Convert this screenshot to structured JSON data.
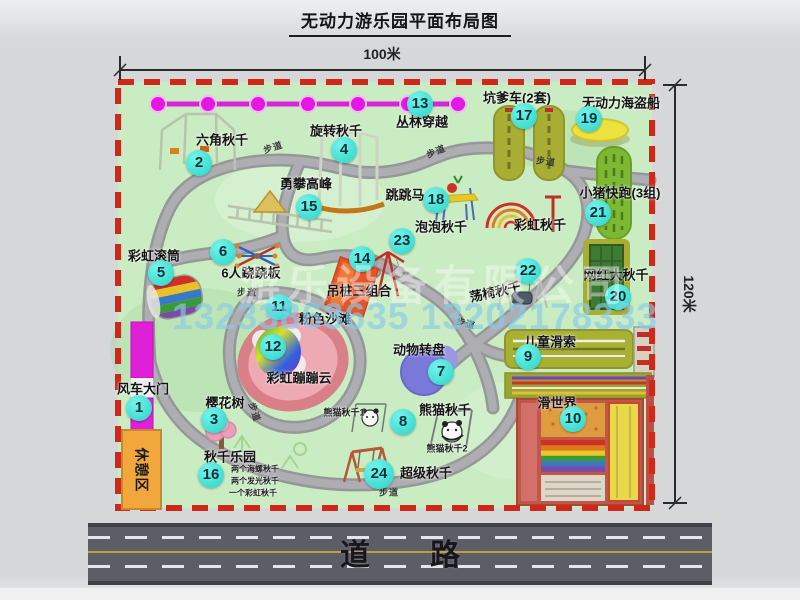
{
  "title": "无动力游乐园平面布局图",
  "dimensions": {
    "top": "100米",
    "right": "120米"
  },
  "road": {
    "label": "道　　路"
  },
  "watermark": {
    "company": "游乐设备有限公司",
    "phone": "13233863635 13202178333"
  },
  "rest_area_label": "休憩区",
  "walkway_text": "步道",
  "colors": {
    "map_green": "#c9ecc2",
    "border_dash": "#d02818",
    "path_gray": "#a6a6aa",
    "badge_cyan": "#2bd3c7",
    "gate_magenta": "#e020d8",
    "zipline_magenta": "#dd22dd",
    "road_gray": "#5d5d66",
    "rest_orange": "#f2a73c",
    "beach_pink": "#d97f88"
  },
  "extra_labels": [
    {
      "text": "彩虹秋千",
      "x": 540,
      "y": 224
    }
  ],
  "walkways": [
    {
      "x": 273,
      "y": 147,
      "rot": -18
    },
    {
      "x": 436,
      "y": 151,
      "rot": -22
    },
    {
      "x": 546,
      "y": 161,
      "rot": 8
    },
    {
      "x": 247,
      "y": 292,
      "rot": 0
    },
    {
      "x": 255,
      "y": 412,
      "rot": 72
    },
    {
      "x": 466,
      "y": 323,
      "rot": 14
    },
    {
      "x": 389,
      "y": 492,
      "rot": 0
    }
  ],
  "attractions": [
    {
      "id": 1,
      "name": "风车大门",
      "badge": {
        "x": 139,
        "y": 408
      },
      "label": {
        "x": 143,
        "y": 388
      }
    },
    {
      "id": 2,
      "name": "六角秋千",
      "badge": {
        "x": 199,
        "y": 163
      },
      "label": {
        "x": 222,
        "y": 139
      }
    },
    {
      "id": 3,
      "name": "樱花树",
      "badge": {
        "x": 214,
        "y": 420
      },
      "label": {
        "x": 225,
        "y": 402
      }
    },
    {
      "id": 4,
      "name": "旋转秋千",
      "badge": {
        "x": 344,
        "y": 150
      },
      "label": {
        "x": 336,
        "y": 130
      }
    },
    {
      "id": 5,
      "name": "彩虹滚筒",
      "badge": {
        "x": 161,
        "y": 273
      },
      "label": {
        "x": 154,
        "y": 255
      }
    },
    {
      "id": 6,
      "name": "6人跷跷板",
      "badge": {
        "x": 223,
        "y": 252
      },
      "label": {
        "x": 251,
        "y": 272
      }
    },
    {
      "id": 7,
      "name": "动物转盘",
      "badge": {
        "x": 441,
        "y": 372
      },
      "label": {
        "x": 419,
        "y": 349
      }
    },
    {
      "id": 8,
      "name": "熊猫秋千",
      "badge": {
        "x": 403,
        "y": 422
      },
      "label": {
        "x": 445,
        "y": 409
      },
      "subs": [
        {
          "text": "熊猫秋千1",
          "x": 344,
          "y": 412,
          "size": 9
        },
        {
          "text": "熊猫秋千2",
          "x": 447,
          "y": 448,
          "size": 9
        }
      ]
    },
    {
      "id": 9,
      "name": "儿童滑索",
      "badge": {
        "x": 528,
        "y": 357
      },
      "label": {
        "x": 550,
        "y": 341
      }
    },
    {
      "id": 10,
      "name": "滑世界",
      "badge": {
        "x": 573,
        "y": 419
      },
      "label": {
        "x": 557,
        "y": 402
      }
    },
    {
      "id": 11,
      "name": "粉色沙滩",
      "badge": {
        "x": 279,
        "y": 307
      },
      "label": {
        "x": 325,
        "y": 318
      }
    },
    {
      "id": 12,
      "name": "彩虹蹦蹦云",
      "badge": {
        "x": 273,
        "y": 347
      },
      "label": {
        "x": 299,
        "y": 377
      }
    },
    {
      "id": 13,
      "name": "丛林穿越",
      "badge": {
        "x": 420,
        "y": 104
      },
      "label": {
        "x": 422,
        "y": 121
      }
    },
    {
      "id": 14,
      "name": "吊桩三组合",
      "badge": {
        "x": 362,
        "y": 259
      },
      "label": {
        "x": 359,
        "y": 290
      }
    },
    {
      "id": 15,
      "name": "勇攀高峰",
      "badge": {
        "x": 309,
        "y": 207
      },
      "label": {
        "x": 306,
        "y": 183
      }
    },
    {
      "id": 16,
      "name": "秋千乐园",
      "badge": {
        "x": 211,
        "y": 475
      },
      "label": {
        "x": 230,
        "y": 456
      },
      "subs": [
        {
          "text": "两个海螺秋千",
          "x": 255,
          "y": 469,
          "size": 8
        },
        {
          "text": "两个发光秋千",
          "x": 255,
          "y": 481,
          "size": 8
        },
        {
          "text": "一个彩虹秋千",
          "x": 253,
          "y": 493,
          "size": 8
        }
      ]
    },
    {
      "id": 17,
      "name": "坑爹车(2套)",
      "badge": {
        "x": 524,
        "y": 116
      },
      "label": {
        "x": 517,
        "y": 97
      }
    },
    {
      "id": 18,
      "name": "跳跳马",
      "badge": {
        "x": 436,
        "y": 200
      },
      "label": {
        "x": 405,
        "y": 194
      }
    },
    {
      "id": 19,
      "name": "无动力海盗船",
      "badge": {
        "x": 589,
        "y": 119
      },
      "label": {
        "x": 621,
        "y": 102
      }
    },
    {
      "id": 20,
      "name": "网红大秋千",
      "badge": {
        "x": 618,
        "y": 297
      },
      "label": {
        "x": 616,
        "y": 274
      }
    },
    {
      "id": 21,
      "name": "小猪快跑(3组)",
      "badge": {
        "x": 598,
        "y": 213
      },
      "label": {
        "x": 620,
        "y": 192
      }
    },
    {
      "id": 22,
      "name": "荡椅秋千",
      "badge": {
        "x": 528,
        "y": 271
      },
      "label": {
        "x": 495,
        "y": 291,
        "rot": -12
      }
    },
    {
      "id": 23,
      "name": "泡泡秋千",
      "badge": {
        "x": 402,
        "y": 241
      },
      "label": {
        "x": 441,
        "y": 226
      }
    },
    {
      "id": 24,
      "name": "超级秋千",
      "badge": {
        "x": 379,
        "y": 474,
        "size": 30
      },
      "label": {
        "x": 426,
        "y": 472
      }
    }
  ]
}
